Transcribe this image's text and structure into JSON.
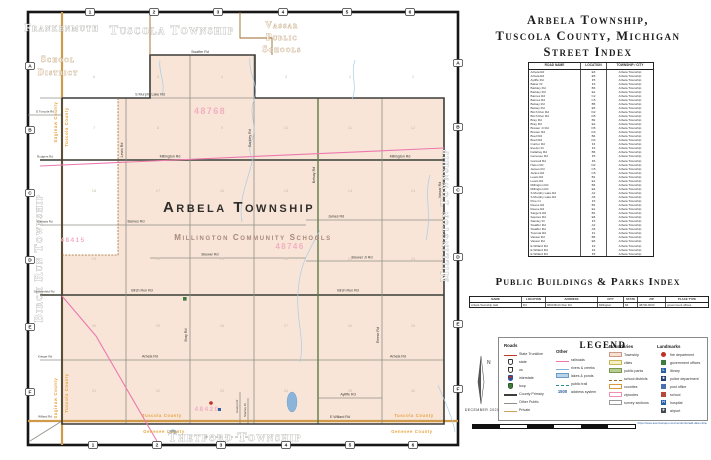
{
  "index_panel": {
    "title_lines": [
      "Arbela Township,",
      "Tuscola County, Michigan",
      "Street Index"
    ],
    "street_index": {
      "headers": [
        "ROAD NAME",
        "LOCATION",
        "TOWNSHIP / CITY"
      ],
      "rows": [
        {
          "road": "Arbela Rd",
          "loc": "E3",
          "town": "Arbela Township"
        },
        {
          "road": "Arbela Rd",
          "loc": "E5",
          "town": "Arbela Township"
        },
        {
          "road": "Ayliffe Rd",
          "loc": "F5",
          "town": "Arbela Township"
        },
        {
          "road": "Baker Dr",
          "loc": "F3",
          "town": "Arbela Township"
        },
        {
          "road": "Barkley Rd",
          "loc": "B3",
          "town": "Arbela Township"
        },
        {
          "road": "Barkley Rd",
          "loc": "E2",
          "town": "Arbela Township"
        },
        {
          "road": "Barnes Rd",
          "loc": "C2",
          "town": "Arbela Township"
        },
        {
          "road": "Barnes Rd",
          "loc": "C5",
          "town": "Arbela Township"
        },
        {
          "road": "Belsay Rd",
          "loc": "B5",
          "town": "Arbela Township"
        },
        {
          "road": "Belsay Rd",
          "loc": "E5",
          "town": "Arbela Township"
        },
        {
          "road": "Birch Run Rd",
          "loc": "D2",
          "town": "Arbela Township"
        },
        {
          "road": "Birch Run Rd",
          "loc": "D5",
          "town": "Arbela Township"
        },
        {
          "road": "Bray Rd",
          "loc": "B2",
          "town": "Arbela Township"
        },
        {
          "road": "Bray Rd",
          "loc": "E2",
          "town": "Arbela Township"
        },
        {
          "road": "Brewer Jr Rd",
          "loc": "D5",
          "town": "Arbela Township"
        },
        {
          "road": "Brewer Rd",
          "loc": "D3",
          "town": "Arbela Township"
        },
        {
          "road": "Buell Rd",
          "loc": "B4",
          "town": "Arbela Township"
        },
        {
          "road": "Buell Rd",
          "loc": "D4",
          "town": "Arbela Township"
        },
        {
          "road": "Currier Rd",
          "loc": "F4",
          "town": "Arbela Township"
        },
        {
          "road": "Evelyn Dr",
          "loc": "F3",
          "town": "Arbela Township"
        },
        {
          "road": "Fallahay Rd",
          "loc": "B6",
          "town": "Arbela Township"
        },
        {
          "road": "Genesee Rd",
          "loc": "F5",
          "town": "Arbela Township"
        },
        {
          "road": "Gunnell Rd",
          "loc": "F6",
          "town": "Arbela Township"
        },
        {
          "road": "Helen Rd",
          "loc": "D2",
          "town": "Arbela Township"
        },
        {
          "road": "James Rd",
          "loc": "C5",
          "town": "Arbela Township"
        },
        {
          "road": "Janice Rd",
          "loc": "C6",
          "town": "Arbela Township"
        },
        {
          "road": "Lewis Rd",
          "loc": "B1",
          "town": "Arbela Township"
        },
        {
          "road": "Lewis Rd",
          "loc": "E1",
          "town": "Arbela Township"
        },
        {
          "road": "Millington Rd",
          "loc": "B4",
          "town": "Arbela Township"
        },
        {
          "road": "Millington Rd",
          "loc": "E4",
          "town": "Arbela Township"
        },
        {
          "road": "S Murphy Lake Rd",
          "loc": "A2",
          "town": "Arbela Township"
        },
        {
          "road": "S Murphy Lake Rd",
          "loc": "A5",
          "town": "Arbela Township"
        },
        {
          "road": "Pine Ct",
          "loc": "F3",
          "town": "Arbela Township"
        },
        {
          "road": "Reese Rd",
          "loc": "B1",
          "town": "Arbela Township"
        },
        {
          "road": "Reese Rd",
          "loc": "E1",
          "town": "Arbela Township"
        },
        {
          "road": "Sargent Rd",
          "loc": "B1",
          "town": "Arbela Township"
        },
        {
          "road": "Squires Rd",
          "loc": "E6",
          "town": "Arbela Township"
        },
        {
          "road": "Stanley Dr",
          "loc": "F3",
          "town": "Arbela Township"
        },
        {
          "road": "Swaffer Rd",
          "loc": "A2",
          "town": "Arbela Township"
        },
        {
          "road": "Swaffer Rd",
          "loc": "A5",
          "town": "Arbela Township"
        },
        {
          "road": "Tuscola Rd",
          "loc": "F1",
          "town": "Arbela Township"
        },
        {
          "road": "Vassar Rd",
          "loc": "B6",
          "town": "Arbela Township"
        },
        {
          "road": "Vassar Rd",
          "loc": "E6",
          "town": "Arbela Township"
        },
        {
          "road": "E Willard Rd",
          "loc": "F2",
          "town": "Arbela Township"
        },
        {
          "road": "E Willard Rd",
          "loc": "F4",
          "town": "Arbela Township"
        },
        {
          "road": "E Willard Rd",
          "loc": "F5",
          "town": "Arbela Township"
        }
      ]
    },
    "buildings_title": "Public Buildings & Parks Index",
    "buildings_index": {
      "headers": [
        "NAME",
        "LOCATION",
        "ADDRESS",
        "CITY",
        "STATE",
        "ZIP",
        "PLACE TYPE"
      ],
      "rows": [
        {
          "name": "Arbela Township Hall",
          "loc": "D3",
          "address": "9600 Birch Run Rd",
          "city": "Millington",
          "state": "MI",
          "zip": "48746-9033",
          "type": "government offices"
        }
      ]
    }
  },
  "legend": {
    "title": "LEGEND",
    "roads": {
      "header": "Roads",
      "items": [
        {
          "label": "State Trunkline",
          "swatch": "sw-line-red"
        },
        {
          "label": "state",
          "swatch": "sw-shield"
        },
        {
          "label": "us",
          "swatch": "sw-shield sw-shield-us"
        },
        {
          "label": "interstate",
          "swatch": "sw-shield sw-shield-int"
        },
        {
          "label": "loop",
          "swatch": "sw-shield sw-shield-loop"
        },
        {
          "label": "County Primary",
          "swatch": "sw-line-dark"
        },
        {
          "label": "Other Public",
          "swatch": "sw-line-thin"
        },
        {
          "label": "Private",
          "swatch": "sw-line-tan"
        }
      ]
    },
    "other": {
      "header": "Other",
      "items": [
        {
          "label": "railroads",
          "swatch": "sw-rail"
        },
        {
          "label": "rivers & creeks",
          "swatch": "sw-river"
        },
        {
          "label": "lakes & ponds",
          "swatch": "sw-lake"
        },
        {
          "label": "public trail",
          "swatch": "sw-trail"
        },
        {
          "label": "address system",
          "swatch": "sw-text",
          "glyph": "1500"
        }
      ]
    },
    "boundaries": {
      "header": "Boundaries",
      "items": [
        {
          "label": "Township",
          "swatch": "sw-b-township"
        },
        {
          "label": "cities",
          "swatch": "sw-b-cities"
        },
        {
          "label": "public parks",
          "swatch": "sw-b-parks"
        },
        {
          "label": "school districts",
          "swatch": "sw-b-school"
        },
        {
          "label": "counties",
          "swatch": "sw-b-county"
        },
        {
          "label": "zipcodes",
          "swatch": "sw-b-zip"
        },
        {
          "label": "survey sections",
          "swatch": "sw-b-survey"
        }
      ]
    },
    "landmarks": {
      "header": "Landmarks",
      "items": [
        {
          "label": "fire department",
          "swatch": "lm lm-fire",
          "glyph": ""
        },
        {
          "label": "government offices",
          "swatch": "lm lm-gov",
          "glyph": ""
        },
        {
          "label": "library",
          "swatch": "lm lm-lib",
          "glyph": "L"
        },
        {
          "label": "police department",
          "swatch": "lm lm-police",
          "glyph": "★"
        },
        {
          "label": "post office",
          "swatch": "lm lm-post",
          "glyph": ""
        },
        {
          "label": "school",
          "swatch": "lm lm-school",
          "glyph": ""
        },
        {
          "label": "hospital",
          "swatch": "lm lm-hosp",
          "glyph": "H"
        },
        {
          "label": "airport",
          "swatch": "lm lm-air",
          "glyph": "✈"
        }
      ]
    }
  },
  "footer": {
    "date": "DECEMBER 2021",
    "compass_label": "N",
    "scale_labels": [
      {
        "v": "0"
      },
      {
        "v": "0.25"
      },
      {
        "v": "0.5"
      },
      {
        "v": "0.75"
      },
      {
        "v": "1"
      },
      {
        "v": "1.25"
      },
      {
        "v": "1.5 Miles"
      }
    ],
    "disclaimer_lines": [
      {
        "v": "Background data from Michigan Center for Geographic Information (MCGI). This map is drawn in"
      },
      {
        "v": "NAD 1983 Michigan GeoRef (TM) (US Survey Ft). The information on this map is thought to be"
      },
      {
        "v": "accurate as of the date of publication; however the author assumes no liability for errors or"
      },
      {
        "v": "omissions and makes no warranties, express or implied. Boundaries shown are approximate and"
      },
      {
        "v": "should not be used for legal descriptions. Please verify with the appropriate authorities before"
      },
      {
        "v": "relying upon this map for any purpose."
      }
    ],
    "credits_lines": [
      {
        "v": "Mapping and Copyright by"
      },
      {
        "v": "Donald Dale Milne"
      },
      {
        "v": "2058 Durham Ct"
      },
      {
        "v": "Saginaw, MI 48609"
      },
      {
        "v": "(989) 781-1348"
      }
    ],
    "credits_url": "https://www.avenzamaps.com/vendor/donald-dale-milne"
  },
  "map": {
    "grid": {
      "cols": [
        "1",
        "2",
        "3",
        "4",
        "5",
        "6"
      ],
      "rows": [
        "A",
        "B",
        "C",
        "D",
        "E",
        "F"
      ]
    },
    "labels": {
      "frankenmuth": "Frankenmuth",
      "school_district_1": "School",
      "school_district_2": "District",
      "tuscola_township": "Tuscola Township",
      "vassar_1": "Vassar",
      "vassar_2": "Public",
      "vassar_3": "Schools",
      "birch_run_township": "Birch Run Township",
      "millington_township": "Millington Township",
      "thetford_township": "Thetford Township",
      "arbela_township": "Arbela Township",
      "millington_schools": "Millington Community Schools",
      "saginaw_county": "Saginaw County",
      "tuscola_county": "Tuscola County",
      "genesee_county": "Genesee County"
    },
    "zips": {
      "vassar": "48768",
      "birch_run": "48415",
      "millington": "48746",
      "clio": "48420"
    },
    "roads": {
      "swaffer": "Swaffer Rd",
      "murphy": "S Murphy Lake Rd",
      "millington": "Millington Rd",
      "barnes": "Barnes Rd",
      "james": "James Rd",
      "brewer": "Brewer Rd",
      "brewer_jr": "Brewer Jr Rd",
      "birch_run": "Birch Run Rd",
      "arbela": "Arbela Rd",
      "willard": "Willard Rd",
      "e_willard": "E Willard Rd",
      "tuscola": "E Tuscola Rd",
      "lewis": "Lewis Rd",
      "bray": "Bray Rd",
      "barkley": "Barkley Rd",
      "belsay": "Belsay Rd",
      "reese": "Reese Rd",
      "vassar": "Vassar Rd",
      "ayliffe": "Ayliffe Rd",
      "evelyn": "Evelyn Dr",
      "stanley": "Stanley Dr",
      "rodgers": "Rodgers Rd",
      "canada": "Canada Rd",
      "sommerfeld": "Sommerfeld Rd",
      "krieger": "Krieger Rd",
      "bell": "Bell Rd"
    },
    "sections": [
      [
        "6",
        "5",
        "4",
        "3",
        "2",
        "1"
      ],
      [
        "7",
        "8",
        "9",
        "10",
        "11",
        "12"
      ],
      [
        "18",
        "17",
        "16",
        "15",
        "14",
        "13"
      ],
      [
        "19",
        "20",
        "21",
        "22",
        "23",
        "24"
      ],
      [
        "30",
        "29",
        "28",
        "27",
        "26",
        "25"
      ],
      [
        "31",
        "32",
        "33",
        "34",
        "35",
        "36"
      ]
    ]
  },
  "colors": {
    "township_fill": "#f8e5d8",
    "county_line": "#cf9b4a",
    "county_text": "#e8a23c",
    "railroad": "#ec79ae",
    "water": "#a9cce6",
    "zip_text": "#f2afc0",
    "state_trunkline": "#c0392b"
  }
}
